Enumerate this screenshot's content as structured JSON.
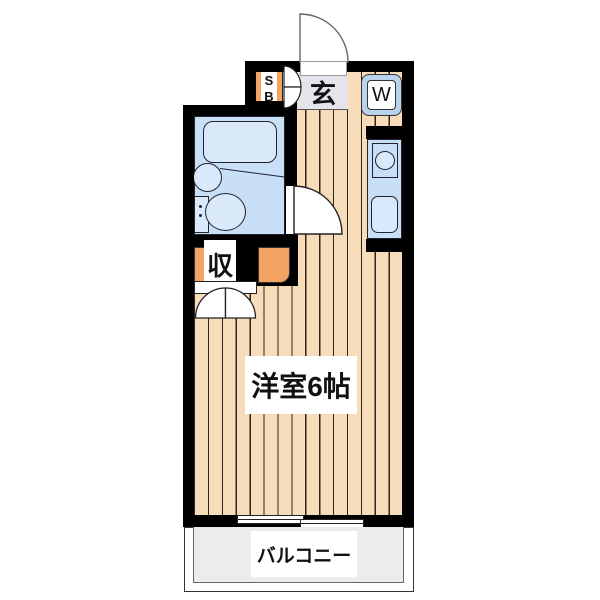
{
  "plan": {
    "title": "one-room apartment floor plan",
    "entrance_label": "玄",
    "shoe_box_label": "SB",
    "washer_label": "W",
    "closet_label": "収",
    "main_room_label": "洋室6帖",
    "balcony_label": "バルコニー"
  },
  "colors": {
    "wall": "#000000",
    "floor": "#f7dcba",
    "bathroom": "#c9dff5",
    "fixture": "#d9e9fa",
    "orange": "#f3a361",
    "genkan": "#e4e4ea",
    "balcony": "#ececec"
  }
}
